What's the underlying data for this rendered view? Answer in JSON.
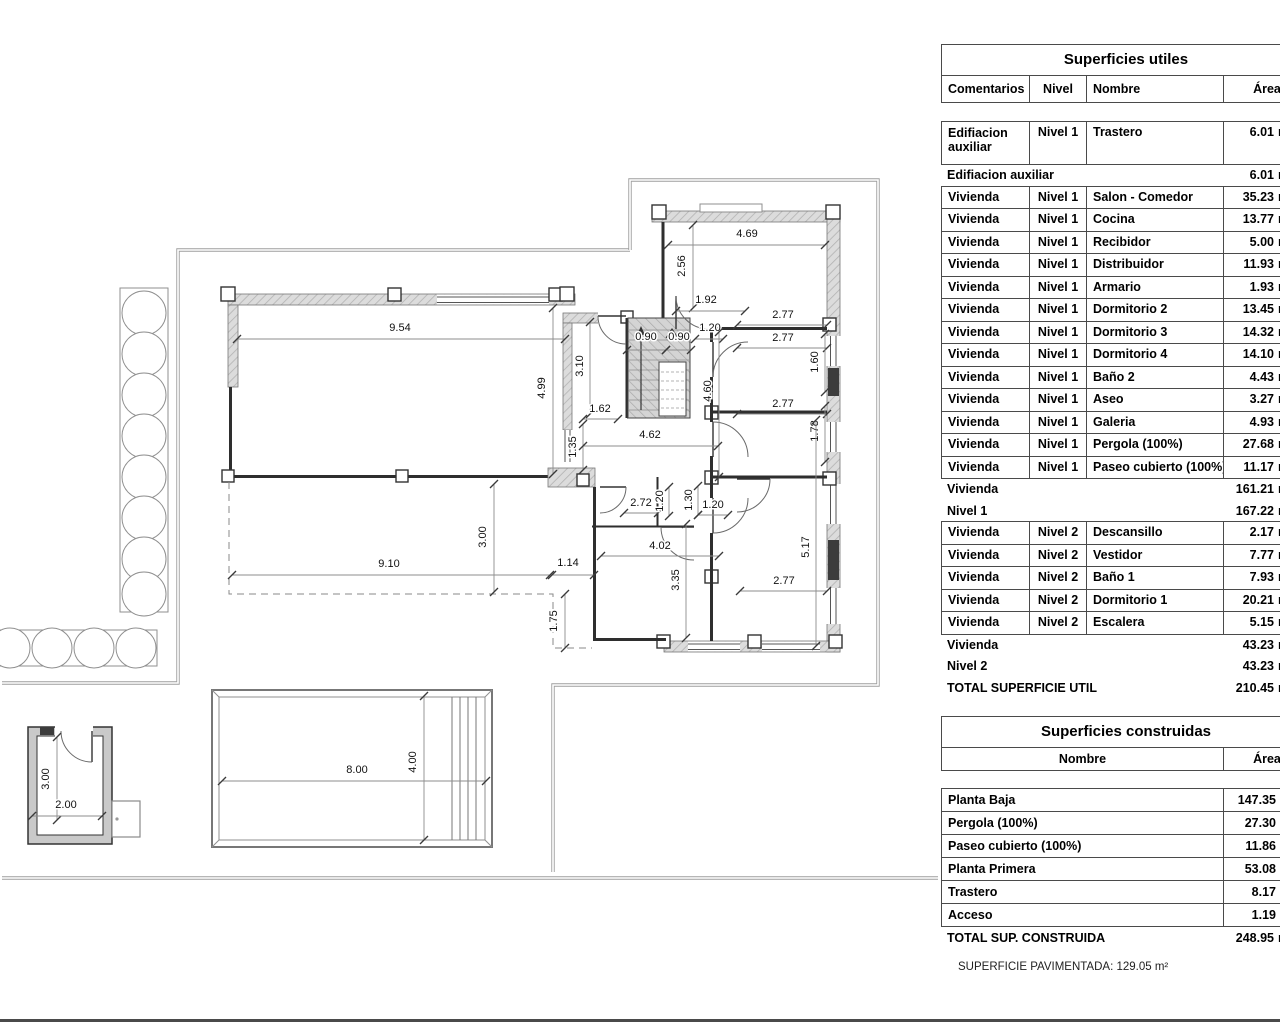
{
  "tables": {
    "utiles": {
      "title": "Superficies utiles",
      "headers": [
        "Comentarios",
        "Nivel",
        "Nombre",
        "Área"
      ],
      "unit": "m²",
      "rows": [
        {
          "type": "data",
          "com": "Edifiacion auxiliar",
          "nivel": "Nivel 1",
          "nombre": "Trastero",
          "area": "6.01",
          "tall": true
        },
        {
          "type": "sub",
          "label": "Edifiacion auxiliar",
          "area": "6.01"
        },
        {
          "type": "data",
          "com": "Vivienda",
          "nivel": "Nivel 1",
          "nombre": "Salon - Comedor",
          "area": "35.23"
        },
        {
          "type": "data",
          "com": "Vivienda",
          "nivel": "Nivel 1",
          "nombre": "Cocina",
          "area": "13.77"
        },
        {
          "type": "data",
          "com": "Vivienda",
          "nivel": "Nivel 1",
          "nombre": "Recibidor",
          "area": "5.00"
        },
        {
          "type": "data",
          "com": "Vivienda",
          "nivel": "Nivel 1",
          "nombre": "Distribuidor",
          "area": "11.93"
        },
        {
          "type": "data",
          "com": "Vivienda",
          "nivel": "Nivel 1",
          "nombre": "Armario",
          "area": "1.93"
        },
        {
          "type": "data",
          "com": "Vivienda",
          "nivel": "Nivel 1",
          "nombre": "Dormitorio 2",
          "area": "13.45"
        },
        {
          "type": "data",
          "com": "Vivienda",
          "nivel": "Nivel 1",
          "nombre": "Dormitorio 3",
          "area": "14.32"
        },
        {
          "type": "data",
          "com": "Vivienda",
          "nivel": "Nivel 1",
          "nombre": "Dormitorio 4",
          "area": "14.10"
        },
        {
          "type": "data",
          "com": "Vivienda",
          "nivel": "Nivel 1",
          "nombre": "Baño 2",
          "area": "4.43"
        },
        {
          "type": "data",
          "com": "Vivienda",
          "nivel": "Nivel 1",
          "nombre": "Aseo",
          "area": "3.27"
        },
        {
          "type": "data",
          "com": "Vivienda",
          "nivel": "Nivel 1",
          "nombre": "Galeria",
          "area": "4.93"
        },
        {
          "type": "data",
          "com": "Vivienda",
          "nivel": "Nivel 1",
          "nombre": "Pergola (100%)",
          "area": "27.68"
        },
        {
          "type": "data",
          "com": "Vivienda",
          "nivel": "Nivel 1",
          "nombre": "Paseo cubierto (100%)",
          "area": "11.17"
        },
        {
          "type": "sub",
          "label": "Vivienda",
          "area": "161.21"
        },
        {
          "type": "sub",
          "label": "Nivel 1",
          "area": "167.22"
        },
        {
          "type": "data",
          "com": "Vivienda",
          "nivel": "Nivel 2",
          "nombre": "Descansillo",
          "area": "2.17"
        },
        {
          "type": "data",
          "com": "Vivienda",
          "nivel": "Nivel 2",
          "nombre": "Vestidor",
          "area": "7.77"
        },
        {
          "type": "data",
          "com": "Vivienda",
          "nivel": "Nivel 2",
          "nombre": "Baño 1",
          "area": "7.93"
        },
        {
          "type": "data",
          "com": "Vivienda",
          "nivel": "Nivel 2",
          "nombre": "Dormitorio 1",
          "area": "20.21"
        },
        {
          "type": "data",
          "com": "Vivienda",
          "nivel": "Nivel 2",
          "nombre": "Escalera",
          "area": "5.15"
        },
        {
          "type": "sub",
          "label": "Vivienda",
          "area": "43.23"
        },
        {
          "type": "sub",
          "label": "Nivel 2",
          "area": "43.23"
        },
        {
          "type": "total",
          "label": "TOTAL SUPERFICIE UTIL",
          "area": "210.45"
        }
      ]
    },
    "construidas": {
      "title": "Superficies construidas",
      "headers": [
        "Nombre",
        "Área"
      ],
      "unit": "m²",
      "rows": [
        {
          "nombre": "Planta Baja",
          "area": "147.35"
        },
        {
          "nombre": "Pergola (100%)",
          "area": "27.30"
        },
        {
          "nombre": "Paseo cubierto (100%)",
          "area": "11.86"
        },
        {
          "nombre": "Planta Primera",
          "area": "53.08"
        },
        {
          "nombre": "Trastero",
          "area": "8.17"
        },
        {
          "nombre": "Acceso",
          "area": "1.19"
        }
      ],
      "total": {
        "label": "TOTAL SUP. CONSTRUIDA",
        "area": "248.95"
      }
    }
  },
  "footer": {
    "paving_note": "SUPERFICIE PAVIMENTADA: 129.05 m²"
  },
  "plan": {
    "dimensions": [
      {
        "t": "9.54",
        "x": 400,
        "y": 331,
        "l": [
          237,
          339,
          565,
          339
        ]
      },
      {
        "t": "4.99",
        "x": 545,
        "y": 388,
        "r": 1,
        "l": [
          553,
          308,
          553,
          474
        ]
      },
      {
        "t": "3.10",
        "x": 583,
        "y": 366,
        "r": 1,
        "l": [
          590,
          322,
          590,
          414
        ]
      },
      {
        "t": "4.69",
        "x": 747,
        "y": 237,
        "l": [
          668,
          245,
          825,
          245
        ]
      },
      {
        "t": "2.56",
        "x": 685,
        "y": 266,
        "r": 1,
        "l": [
          693,
          225,
          693,
          308
        ]
      },
      {
        "t": "1.92",
        "x": 706,
        "y": 303,
        "l": [
          676,
          311,
          745,
          311
        ]
      },
      {
        "t": "0.90",
        "x": 646,
        "y": 340,
        "l": [
          627,
          350,
          666,
          350
        ]
      },
      {
        "t": "0.90",
        "x": 679,
        "y": 340,
        "l": [
          666,
          350,
          691,
          350
        ]
      },
      {
        "t": "1.20",
        "x": 710,
        "y": 331,
        "l": [
          695,
          339,
          723,
          339
        ]
      },
      {
        "t": "2.77",
        "x": 783,
        "y": 318,
        "l": [
          737,
          325,
          827,
          325
        ]
      },
      {
        "t": "2.77",
        "x": 783,
        "y": 341,
        "l": [
          737,
          348,
          827,
          348
        ]
      },
      {
        "t": "1.60",
        "x": 818,
        "y": 362,
        "r": 1,
        "l": [
          825,
          334,
          825,
          392
        ]
      },
      {
        "t": "4.60",
        "x": 711,
        "y": 391,
        "r": 1,
        "l": [
          719,
          332,
          719,
          477
        ]
      },
      {
        "t": "2.77",
        "x": 783,
        "y": 407,
        "l": [
          737,
          414,
          827,
          414
        ]
      },
      {
        "t": "1.78",
        "x": 818,
        "y": 431,
        "r": 1,
        "l": [
          825,
          406,
          825,
          462
        ]
      },
      {
        "t": "1.62",
        "x": 600,
        "y": 412,
        "l": [
          583,
          419,
          618,
          419
        ]
      },
      {
        "t": "1.35",
        "x": 576,
        "y": 447,
        "r": 1,
        "l": [
          583,
          424,
          583,
          470
        ]
      },
      {
        "t": "4.62",
        "x": 650,
        "y": 438,
        "l": [
          583,
          446,
          718,
          446
        ]
      },
      {
        "t": "2.72",
        "x": 641,
        "y": 506,
        "l": [
          624,
          513,
          658,
          513
        ]
      },
      {
        "t": "1.20",
        "x": 663,
        "y": 501,
        "r": 1,
        "l": [
          669,
          487,
          669,
          516
        ]
      },
      {
        "t": "1.30",
        "x": 692,
        "y": 500,
        "r": 1,
        "l": [
          698,
          486,
          698,
          515
        ]
      },
      {
        "t": "1.20",
        "x": 713,
        "y": 508,
        "l": [
          698,
          515,
          728,
          515
        ]
      },
      {
        "t": "4.02",
        "x": 660,
        "y": 549,
        "l": [
          601,
          556,
          719,
          556
        ]
      },
      {
        "t": "3.35",
        "x": 679,
        "y": 580,
        "r": 1,
        "l": [
          686,
          524,
          686,
          638
        ]
      },
      {
        "t": "2.77",
        "x": 784,
        "y": 584,
        "l": [
          740,
          591,
          827,
          591
        ]
      },
      {
        "t": "5.17",
        "x": 809,
        "y": 547,
        "r": 1,
        "l": [
          816,
          420,
          816,
          646
        ]
      },
      {
        "t": "3.00",
        "x": 486,
        "y": 537,
        "r": 1,
        "l": [
          494,
          484,
          494,
          592
        ]
      },
      {
        "t": "9.10",
        "x": 389,
        "y": 567,
        "l": [
          232,
          575,
          550,
          575
        ]
      },
      {
        "t": "1.14",
        "x": 568,
        "y": 566,
        "l": [
          552,
          575,
          594,
          575
        ]
      },
      {
        "t": "1.75",
        "x": 557,
        "y": 621,
        "r": 1,
        "l": [
          565,
          594,
          565,
          648
        ]
      },
      {
        "t": "8.00",
        "x": 357,
        "y": 773,
        "l": [
          222,
          781,
          486,
          781
        ]
      },
      {
        "t": "4.00",
        "x": 416,
        "y": 762,
        "r": 1,
        "l": [
          424,
          696,
          424,
          840
        ]
      },
      {
        "t": "3.00",
        "x": 49,
        "y": 779,
        "r": 1,
        "l": [
          57,
          737,
          57,
          820
        ]
      },
      {
        "t": "2.00",
        "x": 66,
        "y": 808,
        "l": [
          32,
          816,
          102,
          816
        ]
      }
    ]
  }
}
